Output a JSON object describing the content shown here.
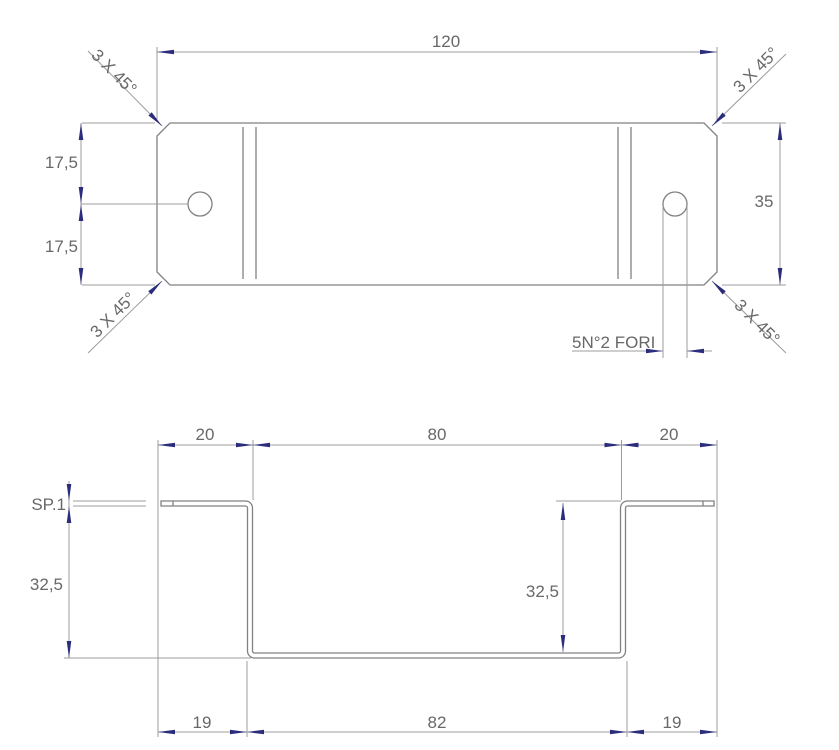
{
  "drawing": {
    "top_view": {
      "length": "120",
      "width": "35",
      "half_width_upper": "17,5",
      "half_width_lower": "17,5",
      "chamfer_note": "3 X 45°",
      "holes_note": "5N°2 FORI"
    },
    "section_view": {
      "flange_left": "20",
      "span_top": "80",
      "flange_right": "20",
      "thickness_label": "SP.1",
      "height_outer": "32,5",
      "height_inner": "32,5",
      "bottom_left": "19",
      "bottom_span": "82",
      "bottom_right": "19"
    },
    "colors": {
      "line": "#818181",
      "dim": "#9c9c9c",
      "text": "#686868",
      "arrow": "#2b2c7c"
    }
  }
}
